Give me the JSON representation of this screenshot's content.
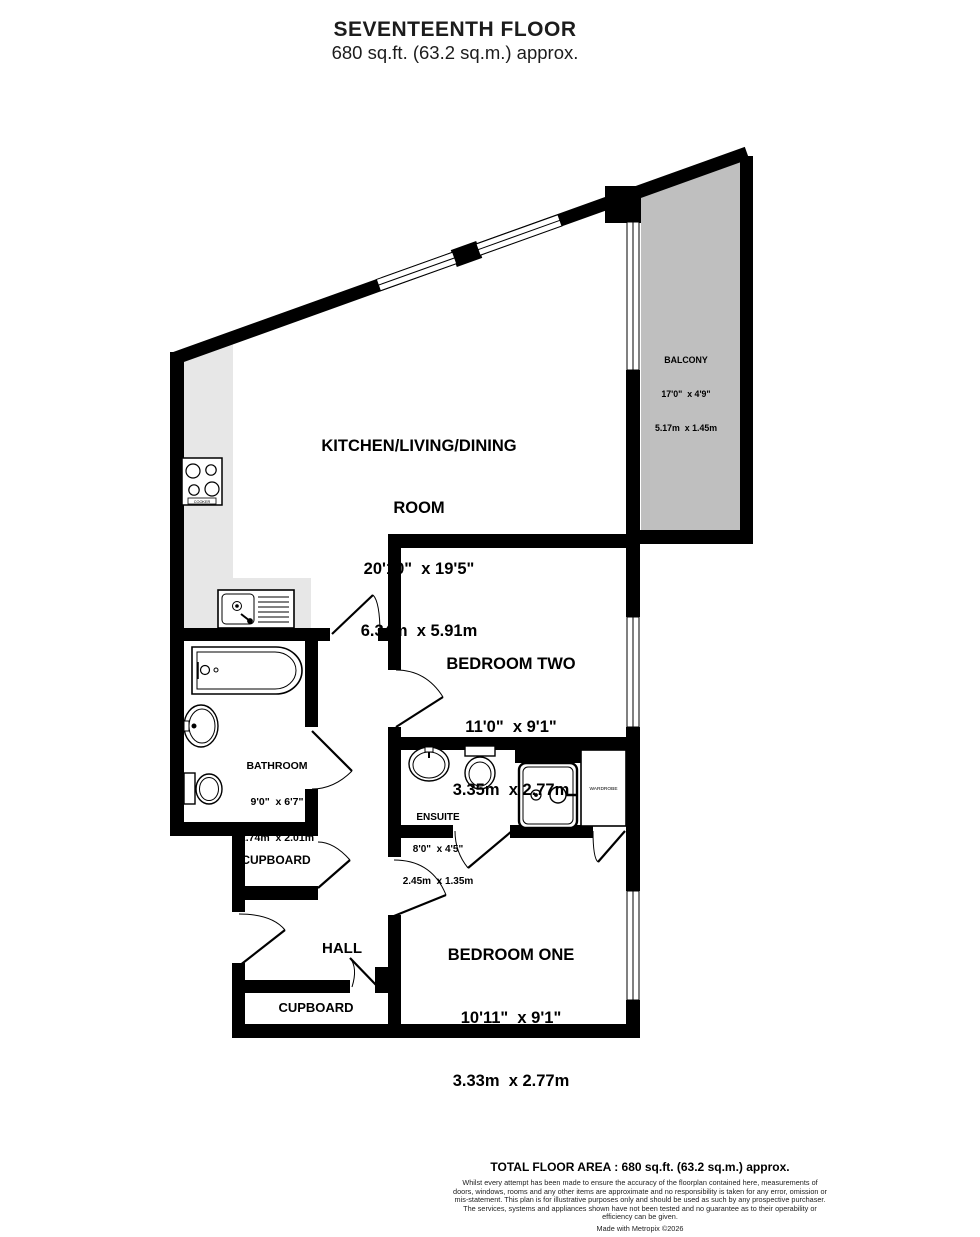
{
  "header": {
    "title": "SEVENTEENTH FLOOR",
    "subtitle": "680 sq.ft. (63.2 sq.m.) approx."
  },
  "rooms": {
    "kitchen": {
      "name_line1": "KITCHEN/LIVING/DINING",
      "name_line2": "ROOM",
      "imperial": "20'10\"  x 19'5\"",
      "metric": "6.34m  x 5.91m"
    },
    "balcony": {
      "name": "BALCONY",
      "imperial": "17'0\"  x 4'9\"",
      "metric": "5.17m  x 1.45m"
    },
    "bedroom_two": {
      "name": "BEDROOM TWO",
      "imperial": "11'0\"  x 9'1\"",
      "metric": "3.35m  x 2.77m"
    },
    "bathroom": {
      "name": "BATHROOM",
      "imperial": "9'0\"  x 6'7\"",
      "metric": "2.74m  x 2.01m"
    },
    "ensuite": {
      "name": "ENSUITE",
      "imperial": "8'0\"  x 4'5\"",
      "metric": "2.45m  x 1.35m"
    },
    "bedroom_one": {
      "name": "BEDROOM ONE",
      "imperial": "10'11\"  x 9'1\"",
      "metric": "3.33m  x 2.77m"
    },
    "hall": {
      "name": "HALL"
    },
    "cupboard_upper": {
      "name": "CUPBOARD"
    },
    "cupboard_lower": {
      "name": "CUPBOARD"
    },
    "wardrobe": {
      "name": "WARDROBE"
    }
  },
  "fixtures": {
    "cooker": "COOKER"
  },
  "footer": {
    "total": "TOTAL FLOOR AREA : 680 sq.ft. (63.2 sq.m.) approx.",
    "disclaimer": "Whilst every attempt has been made to ensure the accuracy of the floorplan contained here, measurements of doors, windows, rooms and any other items are approximate and no responsibility is taken for any error, omission or mis-statement. This plan is for illustrative purposes only and should be used as such by any prospective purchaser. The services, systems and appliances shown have not been tested and no guarantee as to their operability or efficiency can be given.",
    "credit": "Made with Metropix ©2026"
  },
  "colors": {
    "wall": "#000000",
    "balcony_fill": "#bfbfbf",
    "counter_fill": "#e7e7e7",
    "background": "#ffffff"
  }
}
